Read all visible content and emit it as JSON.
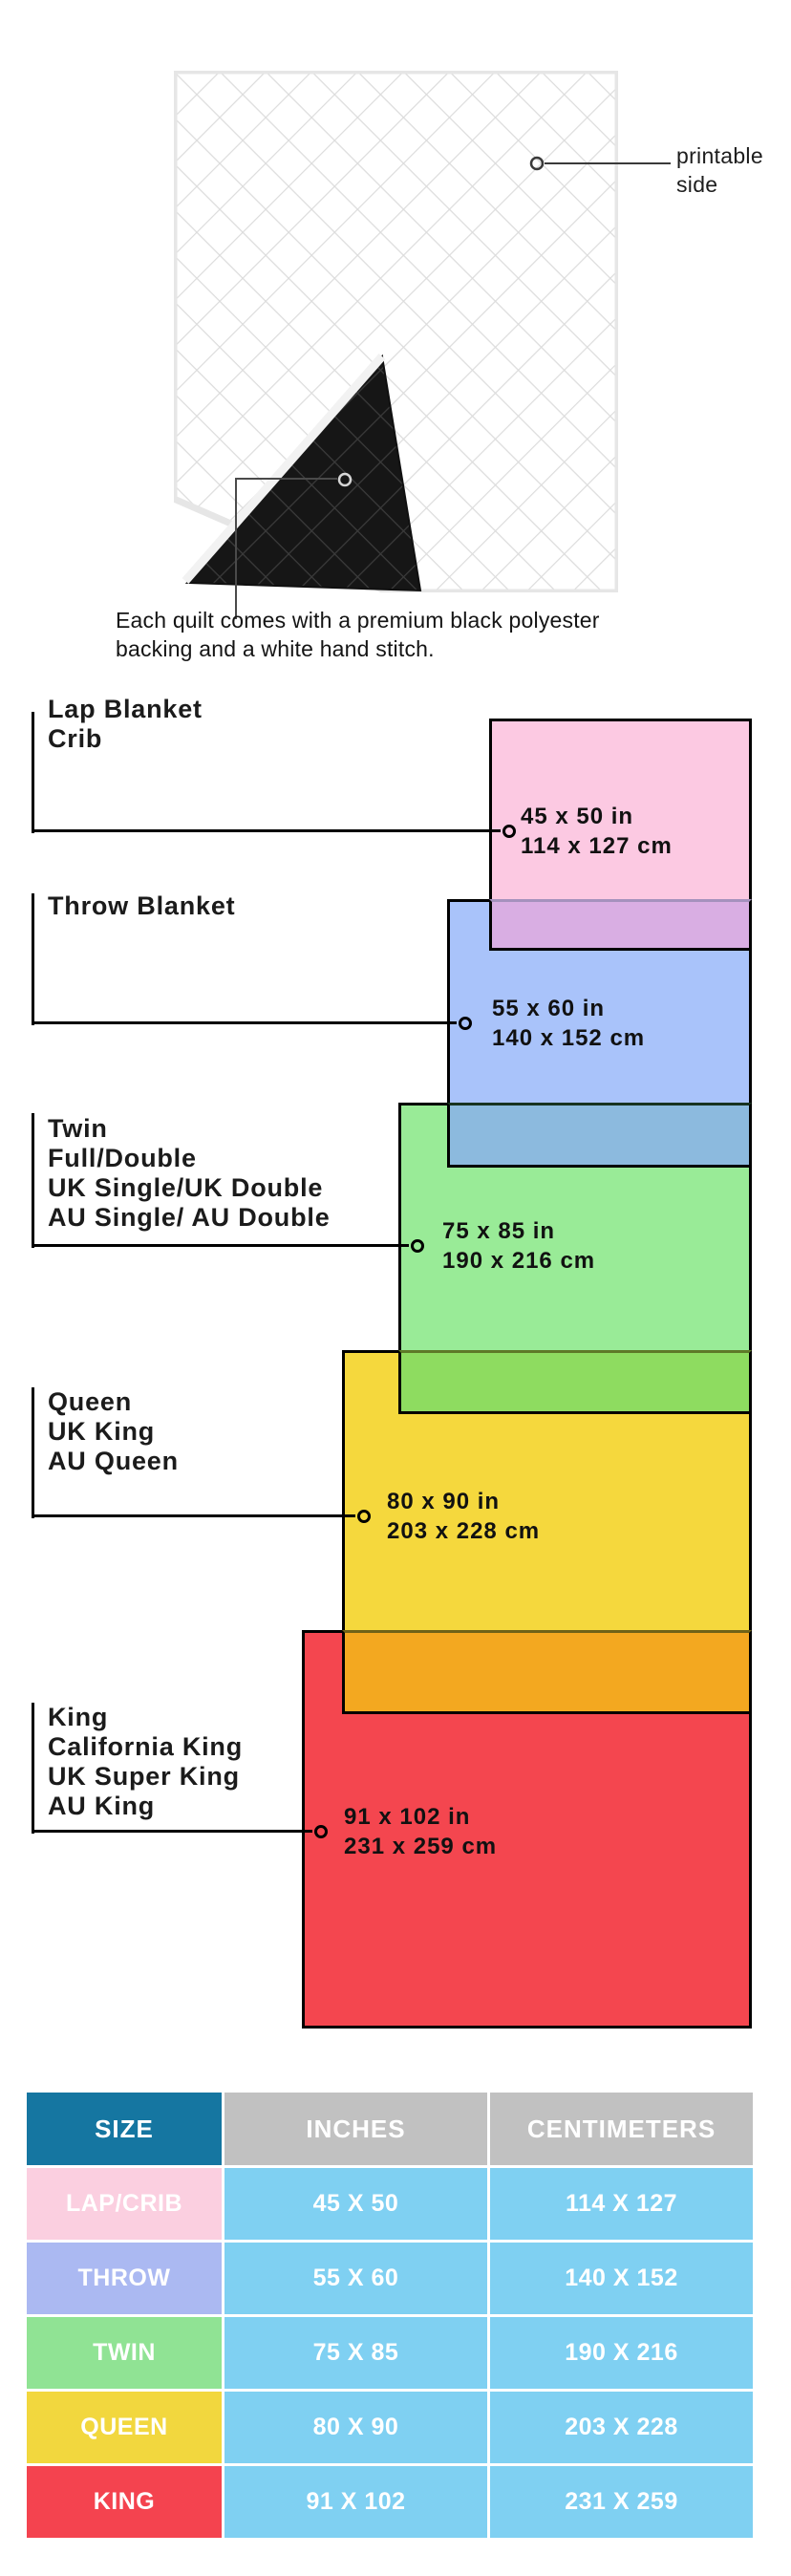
{
  "quilt": {
    "printable_side_label": "printable side",
    "caption": "Each quilt comes with a premium black polyester backing and a white hand stitch."
  },
  "diagram": {
    "sizes": [
      {
        "id": "lap",
        "label_lines": [
          "Lap Blanket",
          "Crib"
        ],
        "inches": "45 x 50 in",
        "cm": "114 x 127 cm",
        "color": "#FCC9E2",
        "overlap_color": null
      },
      {
        "id": "throw",
        "label_lines": [
          "Throw Blanket"
        ],
        "inches": "55 x 60 in",
        "cm": "140 x 152 cm",
        "color": "#A9C3FA",
        "overlap_color": "#D9AEE3"
      },
      {
        "id": "twin",
        "label_lines": [
          "Twin",
          "Full/Double",
          "UK Single/UK Double",
          "AU Single/ AU Double"
        ],
        "inches": "75 x 85 in",
        "cm": "190 x 216 cm",
        "color": "#99EB97",
        "overlap_color": "#8CBADE"
      },
      {
        "id": "queen",
        "label_lines": [
          "Queen",
          "UK King",
          "AU Queen"
        ],
        "inches": "80 x 90 in",
        "cm": "203 x 228 cm",
        "color": "#F5D83D",
        "overlap_color": "#8EDC60"
      },
      {
        "id": "king",
        "label_lines": [
          "King",
          "California King",
          "UK Super King",
          "AU King"
        ],
        "inches": "91 x 102 in",
        "cm": "231 x 259 cm",
        "color": "#F4464F",
        "overlap_color": "#F3A820"
      }
    ]
  },
  "table": {
    "headers": [
      "SIZE",
      "INCHES",
      "CENTIMETERS"
    ],
    "header_colors": {
      "size": "#1576A1",
      "data": "#C1C1C1"
    },
    "cell_color": "#7FD0F2",
    "rows": [
      {
        "label": "LAP/CRIB",
        "color": "#FBCFE0",
        "inches": "45 X 50",
        "cm": "114 X 127"
      },
      {
        "label": "THROW",
        "color": "#ABB9F2",
        "inches": "55 X 60",
        "cm": "140 X 152"
      },
      {
        "label": "TWIN",
        "color": "#90E394",
        "inches": "75 X 85",
        "cm": "190 X 216"
      },
      {
        "label": "QUEEN",
        "color": "#F2D73E",
        "inches": "80 X 90",
        "cm": "203 X 228"
      },
      {
        "label": "KING",
        "color": "#F4434F",
        "inches": "91 X 102",
        "cm": "231 X 259"
      }
    ]
  },
  "chart_data": {
    "type": "table",
    "title": "Quilt size guide",
    "categories": [
      "LAP/CRIB",
      "THROW",
      "TWIN",
      "QUEEN",
      "KING"
    ],
    "series": [
      {
        "name": "inches",
        "values": [
          "45 x 50",
          "55 x 60",
          "75 x 85",
          "80 x 90",
          "91 x 102"
        ]
      },
      {
        "name": "centimeters",
        "values": [
          "114 x 127",
          "140 x 152",
          "190 x 216",
          "203 x 228",
          "231 x 259"
        ]
      }
    ]
  }
}
